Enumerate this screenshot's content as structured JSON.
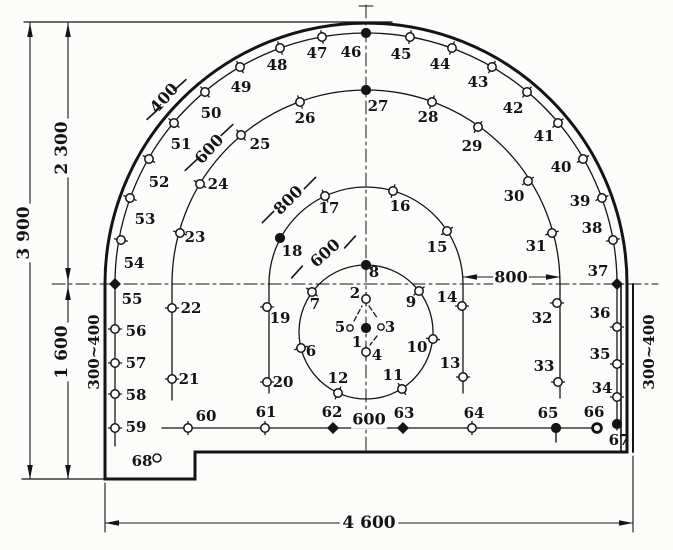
{
  "figure": {
    "title": "blast-hole-pattern-diagram",
    "ink": "#141414",
    "paper": "#fcfcfa",
    "width": 673,
    "height": 550
  },
  "diagram": {
    "contour_paths": [
      [
        "M 627,284 A 261 261 0 0 0 105,284 L 105,479 L 195,479 L 195,452 L 627,452 Z",
        3,
        "tunnel-contour"
      ],
      [
        "M 621,285 L 621,451",
        1.6,
        "tunnel-inner-wall-right"
      ]
    ],
    "ring_paths": [
      [
        "M 617,284 A 251 251 0 0 0 115,284",
        1.3,
        "ring-4-arc"
      ],
      [
        "M 560,284 A 194 194 0 0 0 172,284",
        1.3,
        "ring-3-arc"
      ],
      [
        "M 463,284 A 97 97 0 0 0 269,284",
        1.3,
        "ring-2-arc"
      ]
    ],
    "circles": [
      [
        366,
        332,
        67,
        1.3,
        "cut-circle"
      ]
    ],
    "lines": [
      [
        24,
        22,
        392,
        22,
        1.2,
        "",
        "top-extension-line"
      ],
      [
        359,
        6,
        373,
        6,
        1.1,
        "",
        "centerline-top-tick"
      ],
      [
        366,
        5,
        366,
        452,
        1,
        "13 4 3 4",
        "vertical-centerline"
      ],
      [
        52,
        284,
        658,
        284,
        1,
        "13 4 3 4",
        "horizontal-springline"
      ],
      [
        115,
        284,
        115,
        446,
        1.3,
        "",
        "ring-4-left-wall-line"
      ],
      [
        617,
        284,
        617,
        430,
        1.3,
        "",
        "ring-4-right-wall-line"
      ],
      [
        172,
        284,
        172,
        400,
        1.3,
        "",
        "ring-3-left-line"
      ],
      [
        560,
        284,
        560,
        398,
        1.3,
        "",
        "ring-3-right-line"
      ],
      [
        269,
        284,
        269,
        393,
        1.3,
        "",
        "ring-2-left-line"
      ],
      [
        463,
        284,
        463,
        393,
        1.3,
        "",
        "ring-2-right-line"
      ],
      [
        162,
        428,
        600,
        428,
        1.3,
        "",
        "bottom-hole-row-line"
      ],
      [
        30,
        23,
        30,
        479,
        1.1,
        "",
        "dim-line-3900"
      ],
      [
        68,
        23,
        68,
        284,
        1.1,
        "",
        "dim-line-2300"
      ],
      [
        68,
        284,
        68,
        479,
        1.1,
        "",
        "dim-line-1600"
      ],
      [
        22,
        479,
        105,
        479,
        1.3,
        "",
        "floor-extension-line"
      ],
      [
        105,
        483,
        105,
        532,
        1.1,
        "",
        "dim-ext-left-4600"
      ],
      [
        633,
        456,
        633,
        532,
        1.1,
        "",
        "dim-ext-right-4600"
      ],
      [
        105,
        523,
        633,
        523,
        1.1,
        "",
        "dim-line-4600"
      ],
      [
        463,
        277,
        560,
        277,
        1.1,
        "",
        "dim-line-800-right"
      ],
      [
        180,
        85,
        153,
        114,
        0,
        "",
        "helper"
      ],
      [
        633,
        284,
        633,
        452,
        2,
        "",
        "tunnel-outer-wall-right"
      ]
    ],
    "ticks": [
      [
        180,
        85,
        42,
        16,
        "dim-tick-400-a"
      ],
      [
        153,
        114,
        42,
        16,
        "dim-tick-400-b"
      ],
      [
        227,
        130,
        43,
        16,
        "dim-tick-600r3-a"
      ],
      [
        191,
        165,
        43,
        16,
        "dim-tick-600r3-b"
      ],
      [
        310,
        183,
        45,
        16,
        "dim-tick-800r2-a"
      ],
      [
        268,
        217,
        45,
        16,
        "dim-tick-800r2-b"
      ],
      [
        350,
        242,
        48,
        16,
        "dim-tick-600r1-a"
      ],
      [
        297,
        272,
        48,
        16,
        "dim-tick-600r1-b"
      ]
    ],
    "arrows": [
      [
        30,
        23,
        "up",
        "arrow-3900-top"
      ],
      [
        30,
        479,
        "down",
        "arrow-3900-bottom"
      ],
      [
        68,
        23,
        "up",
        "arrow-2300-top"
      ],
      [
        68,
        282,
        "down",
        "arrow-2300-bottom"
      ],
      [
        68,
        286,
        "up",
        "arrow-1600-top"
      ],
      [
        68,
        479,
        "down",
        "arrow-1600-bottom"
      ],
      [
        105,
        523,
        "left",
        "arrow-4600-left"
      ],
      [
        633,
        523,
        "right",
        "arrow-4600-right"
      ],
      [
        463,
        277,
        "left",
        "arrow-800-left"
      ],
      [
        560,
        277,
        "right",
        "arrow-800-right"
      ]
    ],
    "dim_texts": [
      {
        "t": "3 900",
        "x": 24,
        "y": 233,
        "rot": -90,
        "fs": 17,
        "bg": 1,
        "name": "dim-3900"
      },
      {
        "t": "2 300",
        "x": 62,
        "y": 148,
        "rot": -90,
        "fs": 17,
        "bg": 1,
        "name": "dim-2300"
      },
      {
        "t": "1 600",
        "x": 62,
        "y": 352,
        "rot": -90,
        "fs": 17,
        "bg": 1,
        "name": "dim-1600"
      },
      {
        "t": "300~400",
        "x": 94,
        "y": 352,
        "rot": -90,
        "fs": 15,
        "bg": 0,
        "name": "dim-300-400-left"
      },
      {
        "t": "300~400",
        "x": 649,
        "y": 352,
        "rot": -90,
        "fs": 15,
        "bg": 0,
        "name": "dim-300-400-right"
      },
      {
        "t": "4 600",
        "x": 369,
        "y": 523,
        "rot": 0,
        "fs": 17,
        "bg": 1,
        "name": "dim-4600"
      },
      {
        "t": "800",
        "x": 511,
        "y": 277,
        "rot": 0,
        "fs": 16,
        "bg": 1,
        "name": "dim-800-right"
      },
      {
        "t": "600",
        "x": 369,
        "y": 419,
        "rot": 0,
        "fs": 16,
        "bg": 1,
        "name": "dim-600-bottom"
      },
      {
        "t": "400",
        "x": 164,
        "y": 98,
        "rot": -48,
        "fs": 16,
        "bg": 0,
        "name": "dim-400-ring4"
      },
      {
        "t": "600",
        "x": 209,
        "y": 149,
        "rot": -47,
        "fs": 16,
        "bg": 0,
        "name": "dim-600-ring3"
      },
      {
        "t": "800",
        "x": 288,
        "y": 200,
        "rot": -45,
        "fs": 16,
        "bg": 0,
        "name": "dim-800-ring2"
      },
      {
        "t": "600",
        "x": 325,
        "y": 253,
        "rot": -42,
        "fs": 16,
        "bg": 0,
        "name": "dim-600-ring1"
      }
    ],
    "cut_connectors": [
      [
        354,
        321,
        362,
        306,
        "cut-dash-5-2"
      ],
      [
        369,
        306,
        378,
        319,
        "cut-dash-2-3"
      ],
      [
        377,
        336,
        370,
        345,
        "cut-dash-3-4"
      ]
    ],
    "holes": [
      [
        1,
        366,
        328,
        "f",
        0,
        357,
        342
      ],
      [
        2,
        366,
        299,
        "o",
        90,
        355,
        293
      ],
      [
        3,
        381,
        327,
        "s",
        0,
        390,
        327
      ],
      [
        4,
        366,
        352,
        "o",
        90,
        377,
        355
      ],
      [
        5,
        350,
        328,
        "s",
        0,
        340,
        327
      ],
      [
        6,
        301,
        348,
        "o",
        15,
        311,
        351
      ],
      [
        7,
        312,
        292,
        "o",
        144,
        315,
        304
      ],
      [
        8,
        366,
        265,
        "f",
        0,
        374,
        272
      ],
      [
        9,
        419,
        291,
        "o",
        38,
        411,
        302
      ],
      [
        10,
        433,
        339,
        "o",
        -6,
        417,
        347
      ],
      [
        11,
        402,
        389,
        "o",
        124,
        393,
        375
      ],
      [
        12,
        338,
        393,
        "o",
        65,
        338,
        378
      ],
      [
        13,
        463,
        377,
        "o",
        0,
        450,
        363
      ],
      [
        14,
        462,
        306,
        "o",
        0,
        447,
        297
      ],
      [
        15,
        447,
        231,
        "o",
        33,
        437,
        247
      ],
      [
        16,
        393,
        191,
        "o",
        74,
        400,
        206
      ],
      [
        17,
        325,
        196,
        "o",
        115,
        329,
        208
      ],
      [
        18,
        280,
        238,
        "f",
        152,
        292,
        251
      ],
      [
        19,
        267,
        307,
        "o",
        0,
        280,
        318
      ],
      [
        20,
        267,
        382,
        "o",
        0,
        283,
        382
      ],
      [
        21,
        172,
        379,
        "o",
        0,
        189,
        379
      ],
      [
        22,
        172,
        308,
        "o",
        0,
        191,
        308
      ],
      [
        23,
        180,
        233,
        "o",
        164,
        195,
        237
      ],
      [
        24,
        200,
        184,
        "o",
        150,
        218,
        184
      ],
      [
        25,
        241,
        135,
        "o",
        130,
        260,
        144
      ],
      [
        26,
        300,
        102,
        "o",
        110,
        305,
        118
      ],
      [
        27,
        366,
        90,
        "f",
        0,
        378,
        106
      ],
      [
        28,
        432,
        102,
        "o",
        70,
        428,
        117
      ],
      [
        29,
        478,
        127,
        "o",
        55,
        472,
        146
      ],
      [
        30,
        528,
        181,
        "o",
        34,
        514,
        196
      ],
      [
        31,
        552,
        233,
        "o",
        16,
        536,
        246
      ],
      [
        32,
        557,
        303,
        "o",
        0,
        542,
        318
      ],
      [
        33,
        558,
        382,
        "o",
        0,
        544,
        366
      ],
      [
        34,
        617,
        397,
        "o",
        0,
        602,
        388
      ],
      [
        35,
        617,
        364,
        "o",
        0,
        600,
        354
      ],
      [
        36,
        617,
        327,
        "o",
        0,
        600,
        313
      ],
      [
        37,
        617,
        284,
        "d",
        0,
        598,
        271
      ],
      [
        38,
        613,
        240,
        "o",
        10,
        592,
        228
      ],
      [
        39,
        602,
        198,
        "o",
        20,
        580,
        201
      ],
      [
        40,
        583,
        159,
        "o",
        30,
        561,
        167
      ],
      [
        41,
        558,
        123,
        "o",
        40,
        544,
        136
      ],
      [
        42,
        527,
        92,
        "o",
        50,
        513,
        108
      ],
      [
        43,
        492,
        67,
        "o",
        60,
        478,
        82
      ],
      [
        44,
        452,
        48,
        "o",
        70,
        440,
        64
      ],
      [
        45,
        410,
        37,
        "o",
        80,
        401,
        54
      ],
      [
        46,
        366,
        33,
        "f",
        0,
        351,
        52
      ],
      [
        47,
        322,
        37,
        "o",
        100,
        317,
        53
      ],
      [
        48,
        280,
        48,
        "o",
        110,
        277,
        65
      ],
      [
        49,
        240,
        67,
        "o",
        120,
        241,
        87
      ],
      [
        50,
        205,
        92,
        "o",
        130,
        211,
        113
      ],
      [
        51,
        174,
        123,
        "o",
        140,
        181,
        144
      ],
      [
        52,
        149,
        159,
        "o",
        150,
        159,
        182
      ],
      [
        53,
        130,
        198,
        "o",
        160,
        145,
        219
      ],
      [
        54,
        121,
        240,
        "o",
        170,
        134,
        263
      ],
      [
        55,
        115,
        284,
        "d",
        0,
        132,
        299
      ],
      [
        56,
        115,
        329,
        "o",
        0,
        136,
        331
      ],
      [
        57,
        115,
        363,
        "o",
        0,
        136,
        363
      ],
      [
        58,
        115,
        394,
        "o",
        0,
        136,
        395
      ],
      [
        59,
        115,
        428,
        "o",
        0,
        136,
        427
      ],
      [
        60,
        188,
        428,
        "o",
        90,
        206,
        416
      ],
      [
        61,
        265,
        428,
        "o",
        90,
        266,
        412
      ],
      [
        62,
        333,
        428,
        "d",
        0,
        332,
        412
      ],
      [
        63,
        403,
        428,
        "d",
        0,
        404,
        413
      ],
      [
        64,
        472,
        428,
        "o",
        90,
        474,
        413
      ],
      [
        65,
        556,
        428,
        "ft",
        0,
        548,
        413
      ],
      [
        66,
        597,
        428,
        "r",
        0,
        594,
        412
      ],
      [
        67,
        617,
        424,
        "f",
        0,
        619,
        440
      ],
      [
        68,
        157,
        458,
        "p",
        0,
        142,
        461
      ]
    ]
  }
}
